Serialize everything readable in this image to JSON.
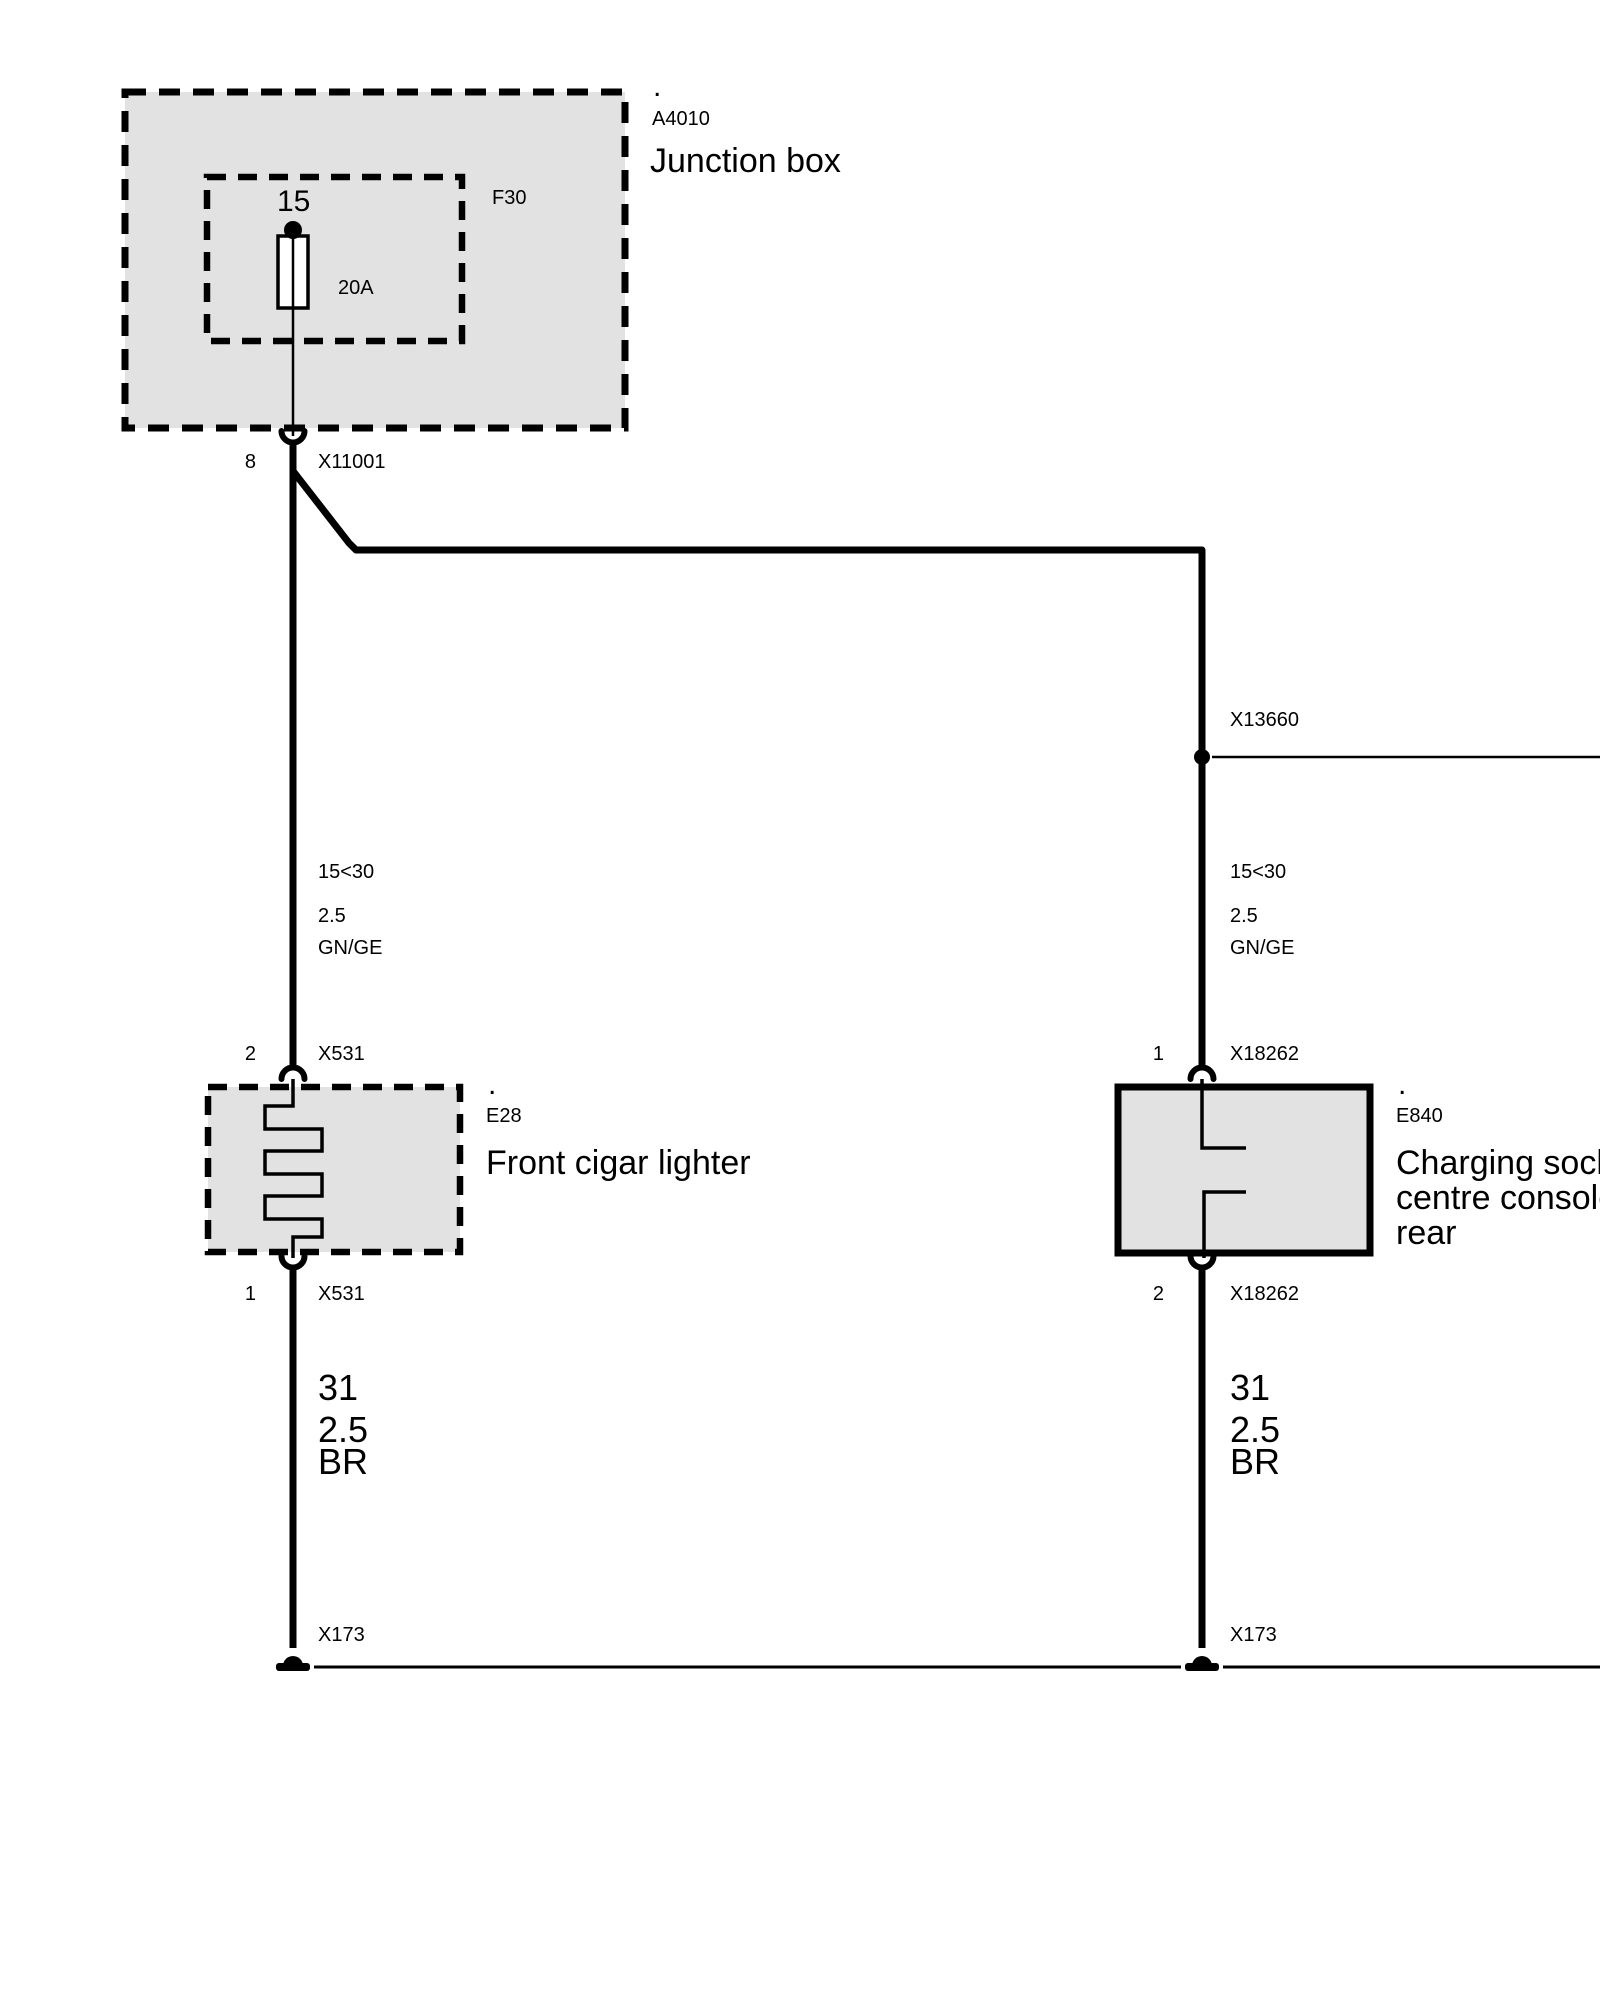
{
  "page": {
    "background": "#ffffff",
    "line_color": "#000000",
    "box_fill": "#e2e2e2"
  },
  "junction_box": {
    "dot": ".",
    "code": "A4010",
    "name": "Junction box",
    "fuse": {
      "terminal": "15",
      "code": "F30",
      "rating": "20A"
    },
    "pin": "8",
    "connector": "X11001"
  },
  "branch": {
    "connector": "X13660"
  },
  "wires": {
    "left_top": {
      "circuit": "15<30",
      "cross_section": "2.5",
      "color_code": "GN/GE"
    },
    "right_top": {
      "circuit": "15<30",
      "cross_section": "2.5",
      "color_code": "GN/GE"
    },
    "left_bottom": {
      "circuit": "31",
      "cross_section": "2.5",
      "color_code": "BR"
    },
    "right_bottom": {
      "circuit": "31",
      "cross_section": "2.5",
      "color_code": "BR"
    }
  },
  "cigar_lighter": {
    "dot": ".",
    "code": "E28",
    "name": "Front cigar lighter",
    "top_pin": "2",
    "top_connector": "X531",
    "bottom_pin": "1",
    "bottom_connector": "X531"
  },
  "charging_socket": {
    "dot": ".",
    "code": "E840",
    "name_line1": "Charging socket",
    "name_line2": "centre console",
    "name_line3": "rear",
    "top_pin": "1",
    "top_connector": "X18262",
    "bottom_pin": "2",
    "bottom_connector": "X18262"
  },
  "grounds": {
    "left": "X173",
    "right": "X173"
  }
}
